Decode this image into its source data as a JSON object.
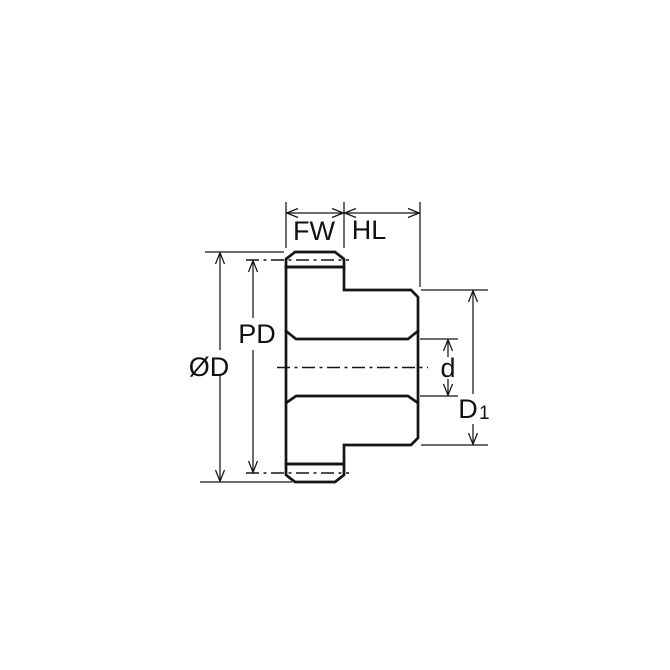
{
  "diagram": {
    "labels": {
      "face_width": "FW",
      "hub_length": "HL",
      "pitch_diameter": "PD",
      "outside_diameter": "ØD",
      "bore_diameter": "d",
      "hub_diameter_main": "D",
      "hub_diameter_sub": "1"
    },
    "colors": {
      "part_fill": "#C9E7F7",
      "tooth_fill": "#FFFFFF",
      "line": "#151515",
      "background": "#FFFFFF"
    }
  }
}
